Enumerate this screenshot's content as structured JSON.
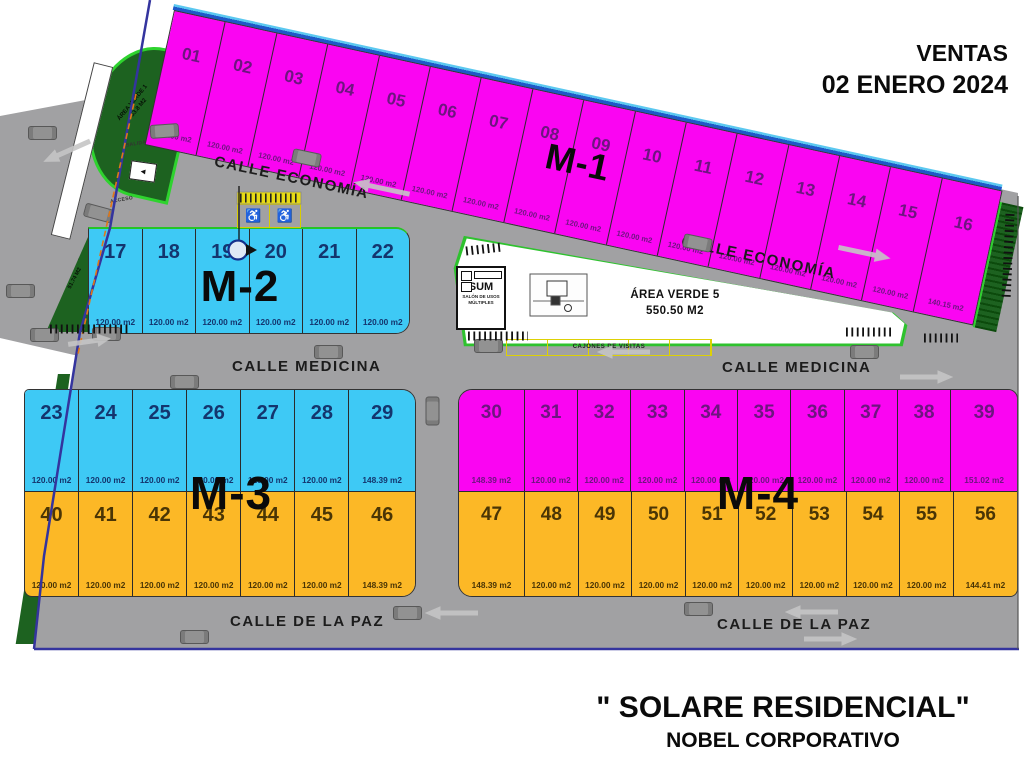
{
  "header": {
    "ventas_line1": "VENTAS",
    "ventas_line2": "02 ENERO 2024"
  },
  "footer": {
    "title": "\" SOLARE RESIDENCIAL\"",
    "subtitle": "NOBEL CORPORATIVO"
  },
  "streets": {
    "economia": "CALLE ECONOMÍA",
    "medicina": "CALLE MEDICINA",
    "paz": "CALLE DE LA PAZ"
  },
  "signs": {
    "salida": "SALIDA",
    "acceso": "ACCESO",
    "visit_parking": "CAJONES DE VISITAS",
    "handicap_icon": "♿",
    "sign_arrow": "◄"
  },
  "sum": {
    "title": "SUM",
    "subtitle": "SALÓN DE USOS MÚLTIPLES"
  },
  "green_areas": {
    "av1": {
      "name": "ÁREA VERDE 1",
      "size": "53.8 M2"
    },
    "av2": {
      "name": "ÁREA VERDE 2",
      "size": ""
    },
    "av3": {
      "name": "ÁREA VERDE 3",
      "size": "51.74 M2"
    },
    "av5": {
      "name": "ÁREA VERDE 5",
      "size": "550.50 M2"
    }
  },
  "blocks": [
    {
      "label": "M-1",
      "rows": [
        {
          "color": "magenta",
          "lots": [
            {
              "num": "01",
              "area": "120.00 m2"
            },
            {
              "num": "02",
              "area": "120.00 m2"
            },
            {
              "num": "03",
              "area": "120.00 m2"
            },
            {
              "num": "04",
              "area": "120.00 m2"
            },
            {
              "num": "05",
              "area": "120.00 m2"
            },
            {
              "num": "06",
              "area": "120.00 m2"
            },
            {
              "num": "07",
              "area": "120.00 m2"
            },
            {
              "num": "08",
              "area": "120.00 m2"
            },
            {
              "num": "09",
              "area": "120.00 m2"
            },
            {
              "num": "10",
              "area": "120.00 m2"
            },
            {
              "num": "11",
              "area": "120.00 m2"
            },
            {
              "num": "12",
              "area": "120.00 m2"
            },
            {
              "num": "13",
              "area": "120.00 m2"
            },
            {
              "num": "14",
              "area": "120.00 m2"
            },
            {
              "num": "15",
              "area": "120.00 m2"
            },
            {
              "num": "16",
              "area": "140.15 m2"
            }
          ]
        }
      ]
    },
    {
      "label": "M-2",
      "rows": [
        {
          "color": "cyan",
          "lots": [
            {
              "num": "17",
              "area": "120.00 m2"
            },
            {
              "num": "18",
              "area": "120.00 m2"
            },
            {
              "num": "19",
              "area": "120.00 m2"
            },
            {
              "num": "20",
              "area": "120.00 m2"
            },
            {
              "num": "21",
              "area": "120.00 m2"
            },
            {
              "num": "22",
              "area": "120.00 m2"
            }
          ]
        }
      ]
    },
    {
      "label": "M-3",
      "rows": [
        {
          "color": "cyan",
          "lots": [
            {
              "num": "23",
              "area": "120.00 m2"
            },
            {
              "num": "24",
              "area": "120.00 m2"
            },
            {
              "num": "25",
              "area": "120.00 m2"
            },
            {
              "num": "26",
              "area": "120.00 m2"
            },
            {
              "num": "27",
              "area": "120.00 m2"
            },
            {
              "num": "28",
              "area": "120.00 m2"
            },
            {
              "num": "29",
              "area": "148.39 m2"
            }
          ]
        },
        {
          "color": "orange",
          "lots": [
            {
              "num": "40",
              "area": "120.00 m2"
            },
            {
              "num": "41",
              "area": "120.00 m2"
            },
            {
              "num": "42",
              "area": "120.00 m2"
            },
            {
              "num": "43",
              "area": "120.00 m2"
            },
            {
              "num": "44",
              "area": "120.00 m2"
            },
            {
              "num": "45",
              "area": "120.00 m2"
            },
            {
              "num": "46",
              "area": "148.39 m2"
            }
          ]
        }
      ]
    },
    {
      "label": "M-4",
      "rows": [
        {
          "color": "magenta",
          "lots": [
            {
              "num": "30",
              "area": "148.39 m2"
            },
            {
              "num": "31",
              "area": "120.00 m2"
            },
            {
              "num": "32",
              "area": "120.00 m2"
            },
            {
              "num": "33",
              "area": "120.00 m2"
            },
            {
              "num": "34",
              "area": "120.00 m2"
            },
            {
              "num": "35",
              "area": "120.00 m2"
            },
            {
              "num": "36",
              "area": "120.00 m2"
            },
            {
              "num": "37",
              "area": "120.00 m2"
            },
            {
              "num": "38",
              "area": "120.00 m2"
            },
            {
              "num": "39",
              "area": "151.02 m2"
            }
          ]
        },
        {
          "color": "orange",
          "lots": [
            {
              "num": "47",
              "area": "148.39 m2"
            },
            {
              "num": "48",
              "area": "120.00 m2"
            },
            {
              "num": "49",
              "area": "120.00 m2"
            },
            {
              "num": "50",
              "area": "120.00 m2"
            },
            {
              "num": "51",
              "area": "120.00 m2"
            },
            {
              "num": "52",
              "area": "120.00 m2"
            },
            {
              "num": "53",
              "area": "120.00 m2"
            },
            {
              "num": "54",
              "area": "120.00 m2"
            },
            {
              "num": "55",
              "area": "120.00 m2"
            },
            {
              "num": "56",
              "area": "144.41 m2"
            }
          ]
        }
      ]
    }
  ],
  "colors": {
    "magenta": "#fa05f2",
    "cyan": "#3ec9f5",
    "orange": "#fcb826",
    "street_gray": "#a1a1a3",
    "green_dark": "#1d6220",
    "green_bright": "#2ed32e",
    "boundary_blue": "#34349e",
    "parking_yellow": "#ddd104"
  }
}
